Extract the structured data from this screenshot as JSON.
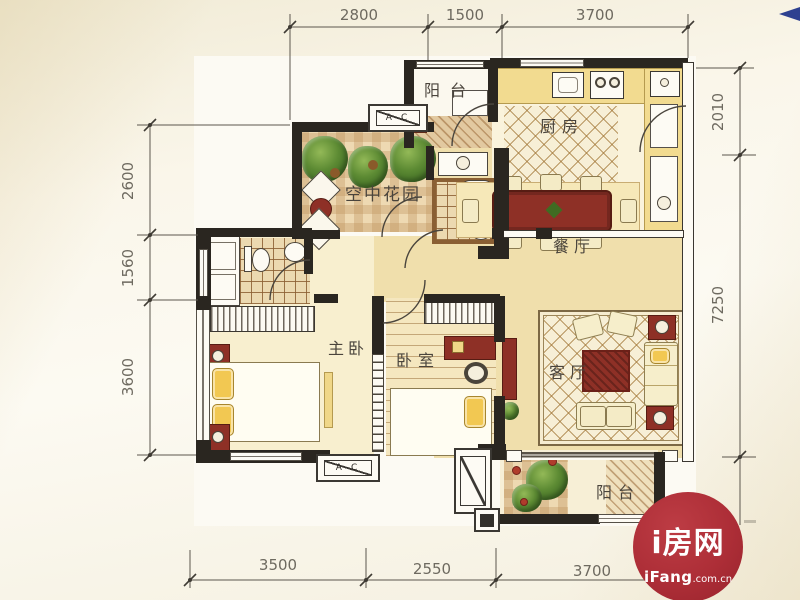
{
  "plan": {
    "rooms": [
      {
        "id": "balcony-top",
        "label": "阳台"
      },
      {
        "id": "kitchen",
        "label": "厨房"
      },
      {
        "id": "sky-garden",
        "label": "空中花园"
      },
      {
        "id": "dining-room",
        "label": "餐厅"
      },
      {
        "id": "master-bedroom",
        "label": "主卧"
      },
      {
        "id": "bedroom",
        "label": "卧室"
      },
      {
        "id": "living-room",
        "label": "客厅"
      },
      {
        "id": "balcony-bottom",
        "label": "阳台"
      }
    ],
    "ac_label": "A-C"
  },
  "dimensions": {
    "top": [
      "2800",
      "1500",
      "3700"
    ],
    "left": [
      "2600",
      "1560",
      "3600"
    ],
    "right": [
      "2010",
      "7250"
    ],
    "bottom": [
      "3500",
      "2550",
      "3700"
    ]
  },
  "watermark": {
    "brand": "i房网",
    "site_name": "iFang",
    "site_suffix": ".com.cn",
    "brand_color": "#ad2e37"
  }
}
